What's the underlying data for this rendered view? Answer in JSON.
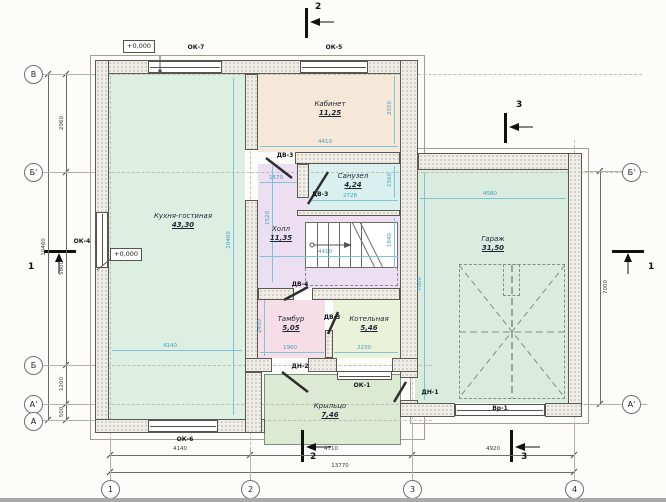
{
  "drawing": {
    "type": "architectural-floor-plan",
    "units": "mm"
  },
  "elevation_mark": "+0,000",
  "rooms": [
    {
      "name": "Кухня-гостиная",
      "area": "43,30"
    },
    {
      "name": "Кабинет",
      "area": "11,25"
    },
    {
      "name": "Санузел",
      "area": "4,24"
    },
    {
      "name": "Холл",
      "area": "11,35"
    },
    {
      "name": "Тамбур",
      "area": "5,05"
    },
    {
      "name": "Котельная",
      "area": "5,46"
    },
    {
      "name": "Гараж",
      "area": "31,50"
    },
    {
      "name": "Крыльцо",
      "area": "7,46"
    }
  ],
  "openings": {
    "ok1": "ОК-1",
    "ok4": "ОК-4",
    "ok5": "ОК-5",
    "ok6": "ОК-6",
    "ok7": "ОК-7",
    "dv3": "ДВ-3",
    "dv4": "ДВ-4",
    "dn1": "ДН-1",
    "dn2": "ДН-2",
    "vr1": "Вр-1"
  },
  "axes": {
    "left": [
      "В",
      "Б'",
      "Б",
      "А'",
      "А"
    ],
    "right": [
      "Б'",
      "А'"
    ],
    "bottom": [
      "1",
      "2",
      "3",
      "4"
    ]
  },
  "sections": {
    "one": "1",
    "two": "2",
    "three": "3"
  },
  "dims": {
    "left_segments": [
      "2960",
      "5800",
      "1200",
      "500"
    ],
    "left_total": "10460",
    "bottom_segments": [
      "4140",
      "4710",
      "4920"
    ],
    "bottom_total": "13770",
    "right_total": "7000",
    "interior": {
      "kitchen_w": "4140",
      "kitchen_h": "10460",
      "kab_w": "4410",
      "kab_h": "2550",
      "san_w": "2728",
      "san_h": "1560",
      "hall_opening": "1570",
      "hall_h": "1520",
      "hall_w": "4410",
      "stair_h": "1840",
      "tambur_h": "2450",
      "tambur_w": "1960",
      "kotel_w": "2230",
      "garage_w": "4580",
      "garage_h": "7000"
    }
  },
  "colors": {
    "kitchen": "#dcefe2",
    "kabinet": "#f6e8d9",
    "sanuzel": "#d9f0ee",
    "hall": "#ecdff2",
    "tambur": "#f7dee6",
    "kotelnaya": "#ebf2da",
    "garage": "#d9ecdf",
    "porch": "#dcead4",
    "dim_interior": "#3f9fbf",
    "dim_exterior": "#3a3a3a",
    "wall_fill": "#f0ede6"
  }
}
